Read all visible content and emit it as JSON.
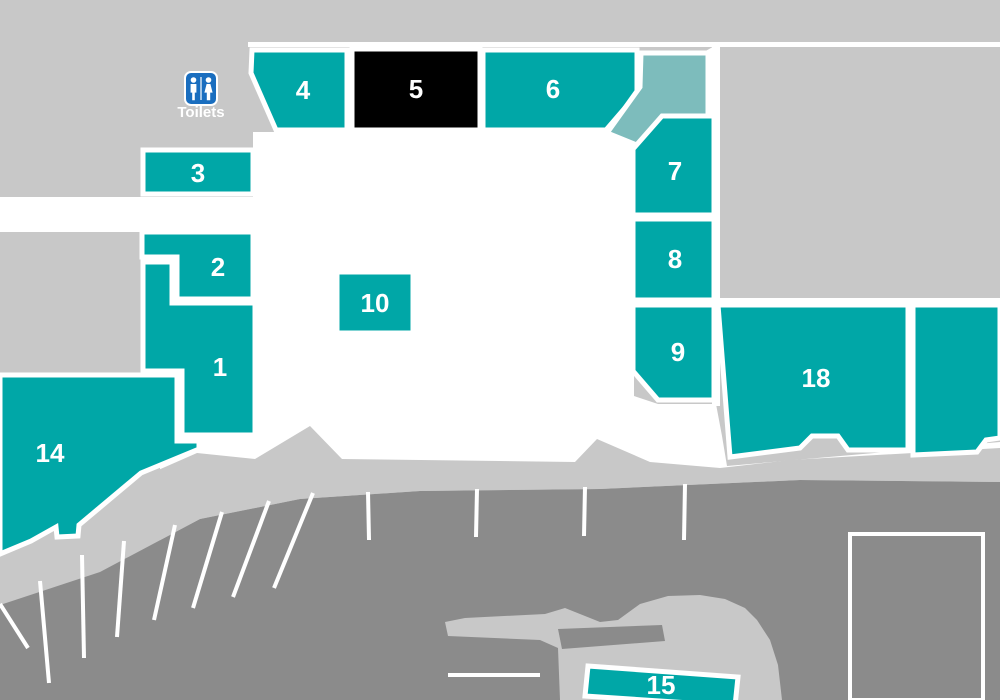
{
  "map_title": "Retail park site map",
  "colors": {
    "background": "#c8c8c8",
    "parking": "#8b8b8b",
    "white": "#ffffff",
    "unit_teal": "#00a7a7",
    "unit_teal_light": "#7dbcbc",
    "unit_black": "#000000",
    "toilets_blue": "#1a6ebf",
    "label_text": "#ffffff"
  },
  "toilets": {
    "label": "Toilets",
    "icon": "restroom-icon",
    "icon_x": 185,
    "icon_y": 72,
    "icon_w": 32,
    "icon_h": 33,
    "text_x": 201,
    "text_y": 117
  },
  "ground": {
    "top_line": "248,42 1000,42 1000,47 248,47",
    "white_areas": [
      "0,197 253,197 253,132 600,132 640,88 718,44 718,125 660,125 634,156 634,396 658,404 716,404 722,436 727,466 1000,442 1000,545 160,545 160,440 253,425 253,232 0,232",
      "712,44 720,44 720,406 712,406",
      "714,298 1000,298 1000,307 714,307"
    ],
    "sidewalk": "0,560 30,547 55,534 58,543 79,542 80,530 140,478 197,453 255,459 310,426 342,459 575,462 597,439 650,462 720,468 790,460 1000,448 1000,482 800,480 600,489 420,491 300,499 200,519 100,572 0,605",
    "parking": "0,605 100,572 200,519 300,499 420,491 600,489 800,480 1000,482 1000,700 0,700"
  },
  "parking_features": {
    "bay_lines": [
      [
        0,
        604,
        28,
        648
      ],
      [
        40,
        581,
        49,
        683
      ],
      [
        82,
        555,
        84,
        658
      ],
      [
        124,
        541,
        117,
        637
      ],
      [
        175,
        525,
        154,
        620
      ],
      [
        222,
        512,
        193,
        608
      ],
      [
        269,
        501,
        233,
        597
      ],
      [
        313,
        493,
        274,
        588
      ],
      [
        368,
        492,
        369,
        540
      ],
      [
        477,
        489,
        476,
        537
      ],
      [
        585,
        487,
        584,
        536
      ],
      [
        685,
        484,
        684,
        540
      ],
      [
        448,
        675,
        540,
        675
      ]
    ],
    "island": "445,622 465,618 545,614 565,608 580,614 600,622 618,620 640,604 668,596 700,595 725,599 745,608 757,620 770,640 778,665 782,700 560,700 558,648 540,640 448,636",
    "island_patch": "558,629 662,625 665,641 562,649",
    "bay_outline_rect": "850,534 983,534 983,700 850,700"
  },
  "units": [
    {
      "id": "1",
      "label": "1",
      "fill": "unit_teal",
      "points": "143,262 172,262 172,303 255,303 255,435 182,435 182,371 143,371",
      "lx": 220,
      "ly": 376
    },
    {
      "id": "2",
      "label": "2",
      "fill": "unit_teal",
      "points": "142,232 253,232 253,299 177,299 177,257 142,257",
      "lx": 218,
      "ly": 276
    },
    {
      "id": "3",
      "label": "3",
      "fill": "unit_teal",
      "points": "143,150 253,150 253,194 143,194",
      "lx": 198,
      "ly": 182
    },
    {
      "id": "4",
      "label": "4",
      "fill": "unit_teal",
      "points": "252,50 347,50 347,130 276,130 251,73",
      "lx": 303,
      "ly": 99
    },
    {
      "id": "5",
      "label": "5",
      "fill": "unit_black",
      "points": "352,49 480,49 480,130 352,130",
      "lx": 416,
      "ly": 98
    },
    {
      "id": "6",
      "label": "6",
      "fill": "unit_teal",
      "points": "483,50 637,50 637,94 606,130 483,130",
      "lx": 553,
      "ly": 98
    },
    {
      "id": "6b",
      "label": "",
      "fill": "unit_teal_light",
      "points": "641,53 708,53 708,116 644,148 607,133 640,87",
      "lx": 0,
      "ly": 0
    },
    {
      "id": "7",
      "label": "7",
      "fill": "unit_teal",
      "points": "662,116 714,116 714,215 633,215 633,149",
      "lx": 675,
      "ly": 180
    },
    {
      "id": "8",
      "label": "8",
      "fill": "unit_teal",
      "points": "633,219 714,219 714,300 633,300",
      "lx": 675,
      "ly": 268
    },
    {
      "id": "9",
      "label": "9",
      "fill": "unit_teal",
      "points": "633,305 714,305 714,400 658,400 633,371",
      "lx": 678,
      "ly": 361
    },
    {
      "id": "10",
      "label": "10",
      "fill": "unit_teal",
      "points": "337,272 413,272 413,333 337,333",
      "lx": 375,
      "ly": 312
    },
    {
      "id": "14",
      "label": "14",
      "fill": "unit_teal",
      "points": "0,375 177,375 177,441 199,441 199,449 141,473 79,525 78,536 57,537 56,527 31,541 0,554",
      "lx": 50,
      "ly": 462
    },
    {
      "id": "15",
      "label": "15",
      "fill": "unit_teal",
      "points": "588,666 738,677 735,706 585,696",
      "lx": 661,
      "ly": 694
    },
    {
      "id": "18",
      "label": "18",
      "fill": "unit_teal",
      "points": "718,305 908,305 908,450 848,450 838,436 812,436 800,448 730,457",
      "lx": 816,
      "ly": 387
    },
    {
      "id": "right-unlabeled",
      "label": "",
      "fill": "unit_teal",
      "points": "913,305 1000,305 1000,438 986,440 977,452 913,455",
      "lx": 0,
      "ly": 0
    }
  ]
}
